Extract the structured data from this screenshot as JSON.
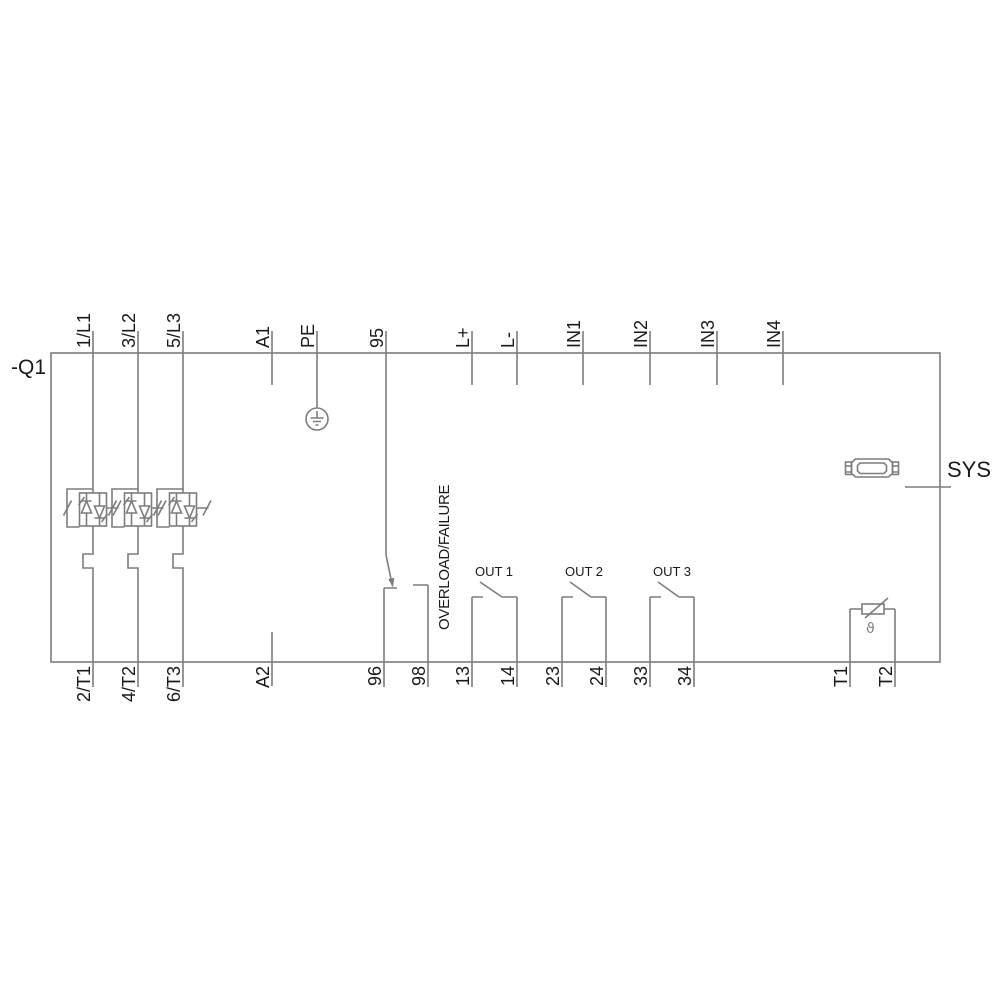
{
  "device": {
    "tag": "-Q1"
  },
  "terminals": {
    "top": [
      {
        "label": "1/L1"
      },
      {
        "label": "3/L2"
      },
      {
        "label": "5/L3"
      },
      {
        "label": "A1"
      },
      {
        "label": "PE"
      },
      {
        "label": "95"
      },
      {
        "label": "L+"
      },
      {
        "label": "L-"
      },
      {
        "label": "IN1"
      },
      {
        "label": "IN2"
      },
      {
        "label": "IN3"
      },
      {
        "label": "IN4"
      }
    ],
    "bottom": [
      {
        "label": "2/T1"
      },
      {
        "label": "4/T2"
      },
      {
        "label": "6/T3"
      },
      {
        "label": "A2"
      },
      {
        "label": "96"
      },
      {
        "label": "98"
      },
      {
        "label": "13"
      },
      {
        "label": "14"
      },
      {
        "label": "23"
      },
      {
        "label": "24"
      },
      {
        "label": "33"
      },
      {
        "label": "34"
      },
      {
        "label": "T1"
      },
      {
        "label": "T2"
      }
    ]
  },
  "relay": {
    "overload_label": "OVERLOAD/FAILURE",
    "outputs": [
      {
        "label": "OUT 1"
      },
      {
        "label": "OUT 2"
      },
      {
        "label": "OUT 3"
      }
    ]
  },
  "sys": {
    "label": "SYS"
  },
  "thermistor": {
    "symbol": "ϑ"
  },
  "icons": {
    "pe_ground": "earth-ground-icon",
    "sys_connector": "system-interface-connector-icon",
    "thermistor": "thermistor-icon",
    "thyristor_module": "antiparallel-thyristor-bypass-icon"
  },
  "colors": {
    "line": "#7d7d7d",
    "text": "#1a1a1a",
    "background": "#ffffff"
  }
}
